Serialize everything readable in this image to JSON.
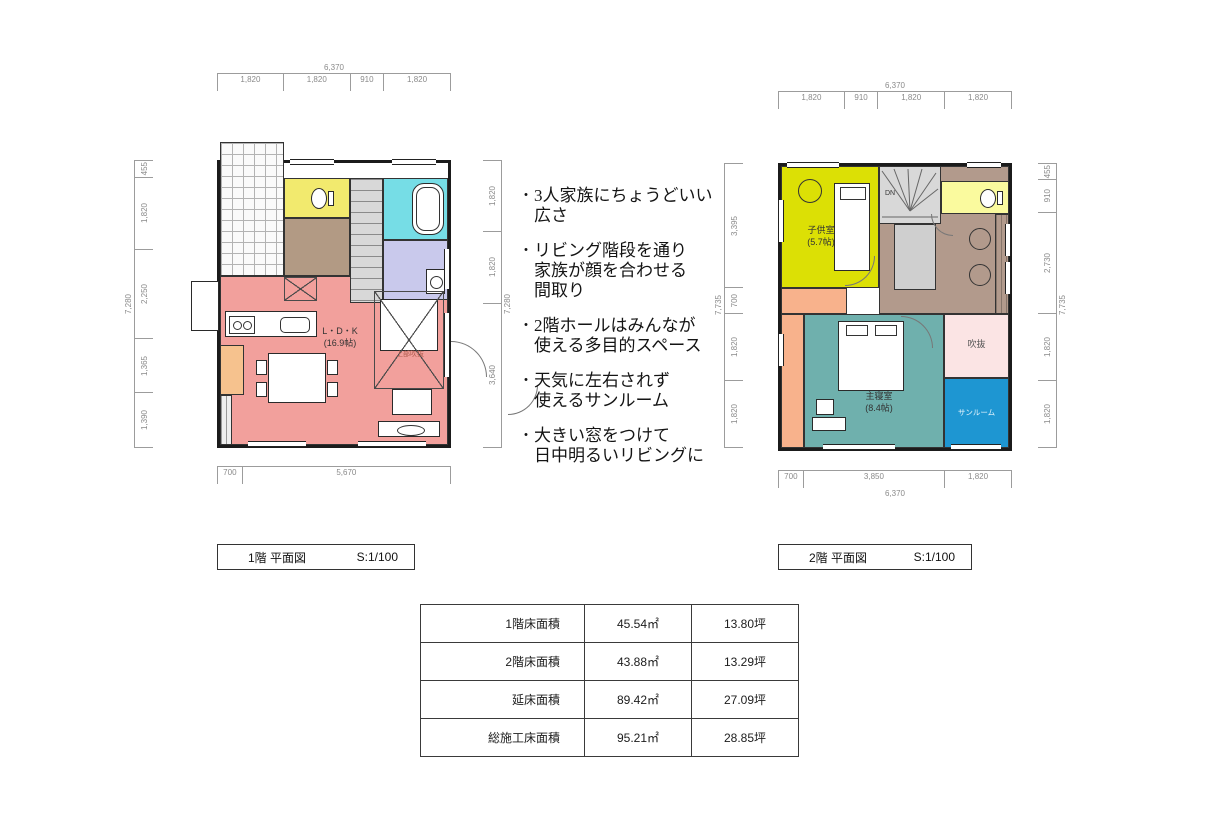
{
  "bullet": "・",
  "notes": [
    "3人家族にちょうどいい\n広さ",
    "リビング階段を通り\n家族が顔を合わせる\n間取り",
    "2階ホールはみんなが\n使える多目的スペース",
    "天気に左右されず\n使えるサンルーム",
    "大きい窓をつけて\n日中明るいリビングに"
  ],
  "plan1": {
    "title": "1階 平面図",
    "scale": "S:1/100",
    "dims": {
      "top_total": "6,370",
      "top": [
        "1,820",
        "1,820",
        "910",
        "1,820"
      ],
      "left_total": "7,280",
      "left": [
        "455",
        "1,820",
        "2,250",
        "1,365",
        "1,390"
      ],
      "right_total": "7,280",
      "right": [
        "1,820",
        "1,820",
        "3,640"
      ],
      "bottom": [
        "700",
        "5,670"
      ]
    },
    "labels": {
      "ldk": "L・D・K",
      "ldk_size": "(16.9帖)",
      "upper_void": "上部吹抜"
    }
  },
  "plan2": {
    "title": "2階 平面図",
    "scale": "S:1/100",
    "dims": {
      "top_total": "6,370",
      "top": [
        "1,820",
        "910",
        "1,820",
        "1,820"
      ],
      "left_total": "7,735",
      "left": [
        "3,395",
        "700",
        "1,820",
        "1,820"
      ],
      "right_total": "7,735",
      "right": [
        "455",
        "910",
        "2,730",
        "1,820",
        "1,820"
      ],
      "bottom": [
        "700",
        "3,850",
        "1,820"
      ],
      "bottom_total": "6,370"
    },
    "labels": {
      "kids_room": "子供室",
      "kids_size": "(5.7帖)",
      "master": "主寝室",
      "master_size": "(8.4帖)",
      "void": "吹抜",
      "sunroom": "サンルーム",
      "stairs_dn": "DN"
    }
  },
  "area_table": {
    "rows": [
      {
        "label": "1階床面積",
        "sqm": "45.54㎡",
        "tsubo": "13.80坪"
      },
      {
        "label": "2階床面積",
        "sqm": "43.88㎡",
        "tsubo": "13.29坪"
      },
      {
        "label": "延床面積",
        "sqm": "89.42㎡",
        "tsubo": "27.09坪"
      },
      {
        "label": "総施工床面積",
        "sqm": "95.21㎡",
        "tsubo": "28.85坪"
      }
    ]
  },
  "colors": {
    "ldk": "#f2a09c",
    "toilet1": "#f2ea6e",
    "bath": "#76dde6",
    "washroom": "#c9c9ec",
    "hall1": "#b29a84",
    "pantry": "#f6c28e",
    "kids_room": "#dce005",
    "toilet2": "#fafa9e",
    "hall2": "#b29a8c",
    "master": "#6fb0ad",
    "closet2": "#f8b28c",
    "void2": "#fbe4e4",
    "sunroom": "#1e96d2",
    "stair_gray": "#cfcfcf"
  }
}
